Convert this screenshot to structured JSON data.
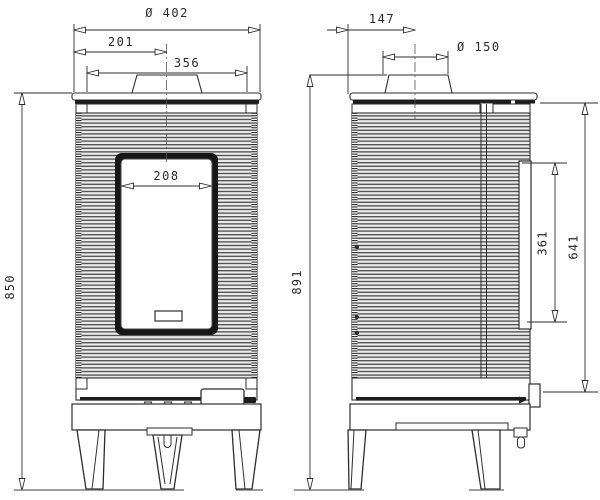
{
  "drawing": {
    "dimensions": {
      "front": {
        "overall_width": "Ø 402",
        "flue_center_from_left": "201",
        "top_plate_width": "356",
        "door_glass_width": "208",
        "height_to_top_plate": "850"
      },
      "side": {
        "flue_center_from_back": "147",
        "flue_diameter": "Ø 150",
        "overall_height": "891",
        "door_glass_height": "361",
        "body_height": "641"
      }
    },
    "colors": {
      "line": "#2e2e2e",
      "dark_fill": "#1d1d1d",
      "background": "#ffffff",
      "rib_dark": "#555555",
      "rib_light": "#ececec"
    }
  }
}
